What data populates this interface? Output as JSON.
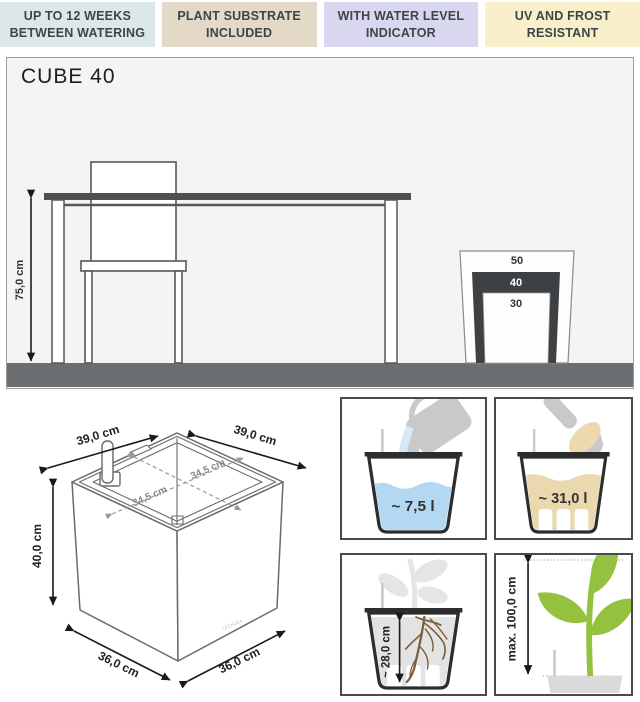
{
  "badges": [
    {
      "label": "UP TO 12 WEEKS\nBETWEEN WATERING",
      "bg": "#dbe7e8"
    },
    {
      "label": "PLANT SUBSTRATE\nINCLUDED",
      "bg": "#e4d8c8"
    },
    {
      "label": "WITH WATER LEVEL\nINDICATOR",
      "bg": "#d9d6f0"
    },
    {
      "label": "UV AND FROST\nRESISTANT",
      "bg": "#f9efca"
    }
  ],
  "size_chart": {
    "title": "CUBE 40",
    "table_height_label": "75,0 cm",
    "sizes": [
      "50",
      "40",
      "30"
    ],
    "highlighted_size": "40"
  },
  "cube_dimensions": {
    "top_left": "39,0 cm",
    "top_right": "39,0 cm",
    "inner_left": "34,5 cm",
    "inner_right": "34,5 cm",
    "height": "40,0 cm",
    "bottom_left": "36,0 cm",
    "bottom_right": "36,0 cm",
    "logo": "LECHUZA"
  },
  "panels": {
    "water": {
      "value": "~ 7,5 l"
    },
    "substrate": {
      "value": "~ 31,0 l"
    },
    "root_depth": {
      "value": "~ 28,0 cm"
    },
    "plant_height": {
      "value": "max. 100,0 cm"
    }
  },
  "icons": [
    "watering-can-icon",
    "trowel-icon",
    "roots-icon",
    "plant-icon",
    "water-level-indicator-icon"
  ],
  "colors": {
    "badge_text": "#3d4547",
    "floor": "#6a6e70",
    "tabletop": "#4d5052",
    "highlight_dark": "#3e4143",
    "water_blue": "#b5d8f2",
    "substrate_tan": "#ead8af",
    "plant_green": "#94c13e",
    "roots_brown": "#7c5e3d"
  }
}
